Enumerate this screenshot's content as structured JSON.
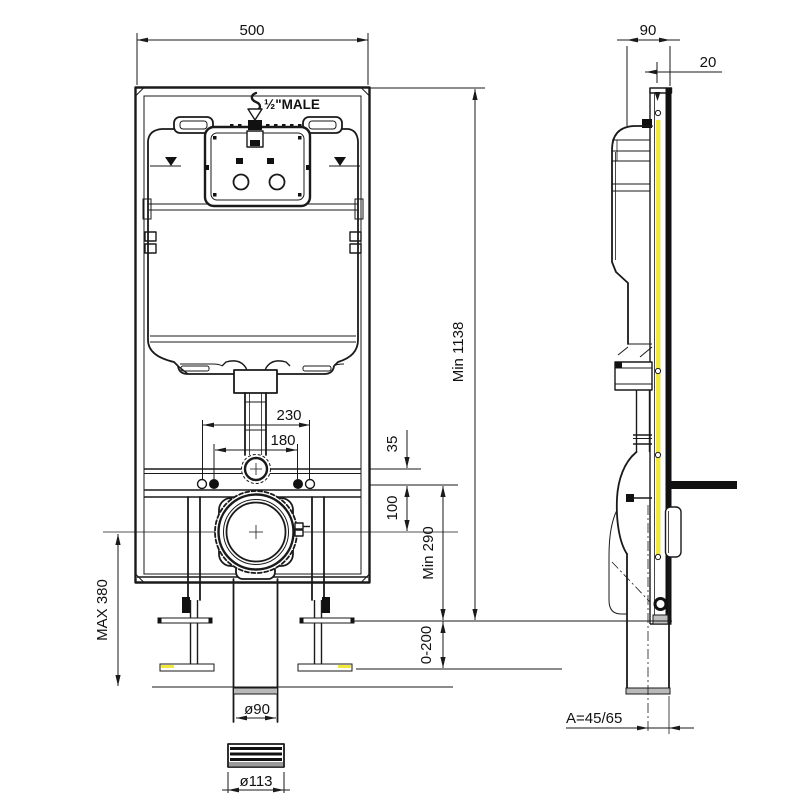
{
  "drawing": {
    "title": "concealed-cistern-frame-installation-drawing",
    "front_view": {
      "frame_width": "500",
      "inlet_label": "½\"MALE",
      "hole_spacing_outer": "230",
      "hole_spacing_inner": "180",
      "flush_pipe_offset": "35",
      "outlet_center_height": "100",
      "outlet_min_height": "Min 290",
      "frame_min_height": "Min 1138",
      "leg_adjust_range": "0-200",
      "leg_max_height": "MAX 380",
      "outlet_pipe_diameter": "ø90",
      "coupling_diameter": "ø113"
    },
    "side_view": {
      "frame_depth": "90",
      "fixing_offset": "20",
      "outlet_offset": "A=45/65"
    },
    "colors": {
      "line": "#1a1a1a",
      "accent_yellow": "#f2e93c",
      "fill_grey": "#b9b9b9"
    }
  }
}
